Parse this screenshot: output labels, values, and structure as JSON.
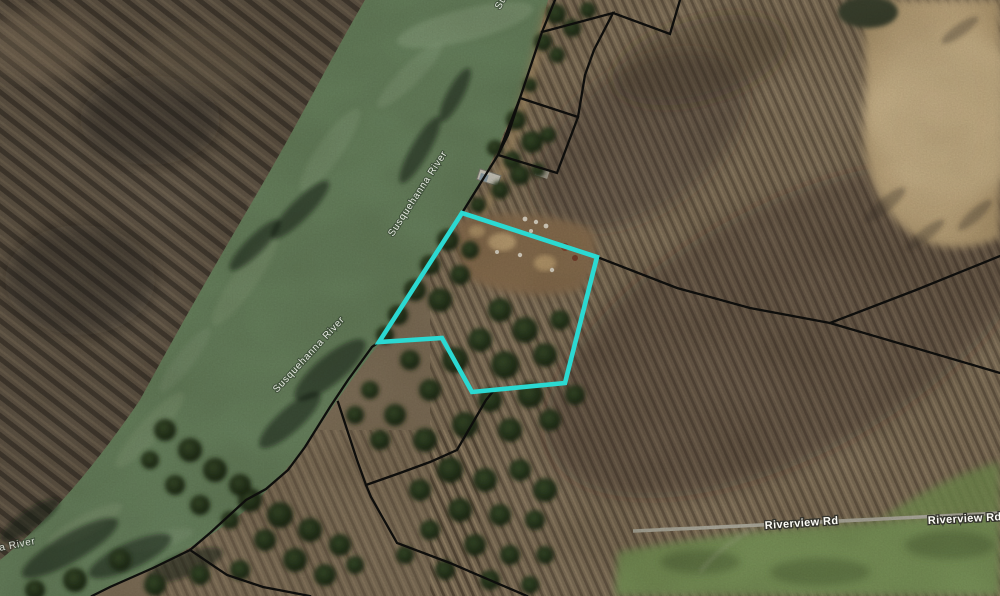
{
  "map": {
    "view": "aerial-imagery-with-parcels",
    "colors": {
      "water": "#6d8a66",
      "parcel_line": "#0e0e0c",
      "highlight": "#2bd9d2",
      "road": "#b6b6ac"
    },
    "labels": {
      "river": [
        {
          "text": "Susquehanna River"
        },
        {
          "text": "Susquehanna River"
        },
        {
          "text": "Susquehanna River"
        },
        {
          "text": "Susquehanna River"
        }
      ],
      "roads": [
        {
          "text": "Riverview Rd"
        },
        {
          "text": "Riverview Rd"
        }
      ]
    },
    "highlight_parcel": {
      "points": "462,213 597,257 565,383 472,392 442,338 379,342"
    },
    "parcel_lines": [
      {
        "name": "river-road-boundary",
        "d": "M555,0 L542,32 L520,98 L508,135 L498,155 L462,213 L379,342 L372,347 L348,380 L330,407 L305,447 L288,470 L266,489 L246,500 L210,533 L190,550 L153,568 L110,587 L92,596"
      },
      {
        "name": "southwest-branch",
        "d": "M190,550 L227,575 L263,587 L310,596"
      },
      {
        "name": "south-branch",
        "d": "M338,402 L357,460 L366,485 L371,497 L397,543 L450,563 L527,596"
      },
      {
        "name": "south-connector",
        "d": "M495,389 L486,400 L457,450 L430,462 L400,473 L366,485"
      },
      {
        "name": "north-parallelogram",
        "d": "M520,98 L578,117 L557,173 L498,155 Z"
      },
      {
        "name": "north-zigzag",
        "d": "M542,32 L613,13 L594,50 L585,75 L578,117 M613,13 L670,34 L680,0"
      },
      {
        "name": "east-boundary",
        "d": "M597,257 L677,288 L750,308 L830,323 L1000,373 M830,323 L916,290 L1000,256"
      }
    ],
    "road_path": {
      "d": "M633,531 L700,528 L760,525 L880,519 L1000,513"
    }
  }
}
